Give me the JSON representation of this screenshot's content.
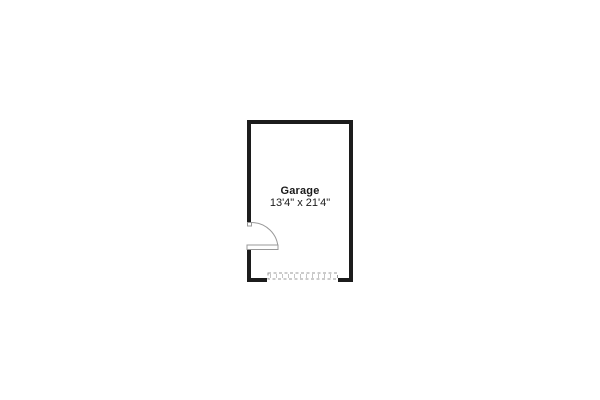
{
  "floorplan": {
    "room": {
      "label": "Garage",
      "dimensions": "13'4\" x 21'4\""
    },
    "symbols": {
      "door": "door-swing-icon",
      "garage_door": "garage-door-icon"
    },
    "colors": {
      "wall": "#1c1c1c",
      "symbol": "#999999",
      "segment_tick": "#c4c4c4",
      "text": "#1a1a1a",
      "background": "#ffffff"
    }
  }
}
